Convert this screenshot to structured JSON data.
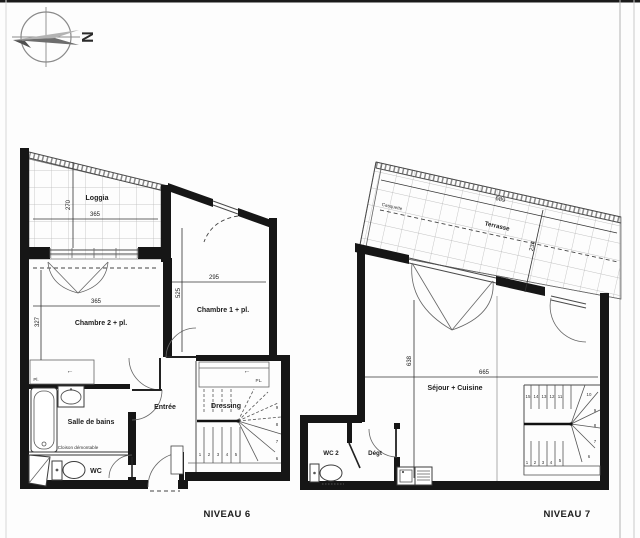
{
  "compass": {
    "north": "N"
  },
  "niveau6": {
    "title": "NIVEAU 6",
    "rooms": {
      "loggia": "Loggia",
      "chambre2": "Chambre 2 + pl.",
      "chambre1": "Chambre 1 + pl.",
      "salle_de_bains": "Salle de bains",
      "wc": "WC",
      "entree": "Entrée",
      "dressing": "Dressing",
      "placard_sdb": "Pl.",
      "placard_dressing": "PL.",
      "cloison": "Cloison démontable"
    },
    "dims": {
      "loggia_h": "270",
      "loggia_w": "365",
      "chambre2_w": "365",
      "chambre2_h": "327",
      "chambre1_w": "295",
      "chambre1_h": "525"
    },
    "arrows": {
      "left": "←"
    },
    "stairs": [
      "1",
      "2",
      "3",
      "4",
      "5",
      "6",
      "7",
      "8",
      "9"
    ]
  },
  "niveau7": {
    "title": "NIVEAU 7",
    "rooms": {
      "terrasse": "Terrasse",
      "casquette": "Casquette",
      "sejour": "Séjour + Cuisine",
      "wc2": "WC 2",
      "degagement": "Dégt"
    },
    "dims": {
      "terrasse_w": "689",
      "terrasse_d": "234",
      "sejour_h": "638",
      "sejour_w": "665"
    },
    "stairs": [
      "1",
      "2",
      "3",
      "4",
      "5",
      "6",
      "7",
      "8",
      "9",
      "10",
      "11",
      "12",
      "13",
      "14",
      "15"
    ]
  }
}
